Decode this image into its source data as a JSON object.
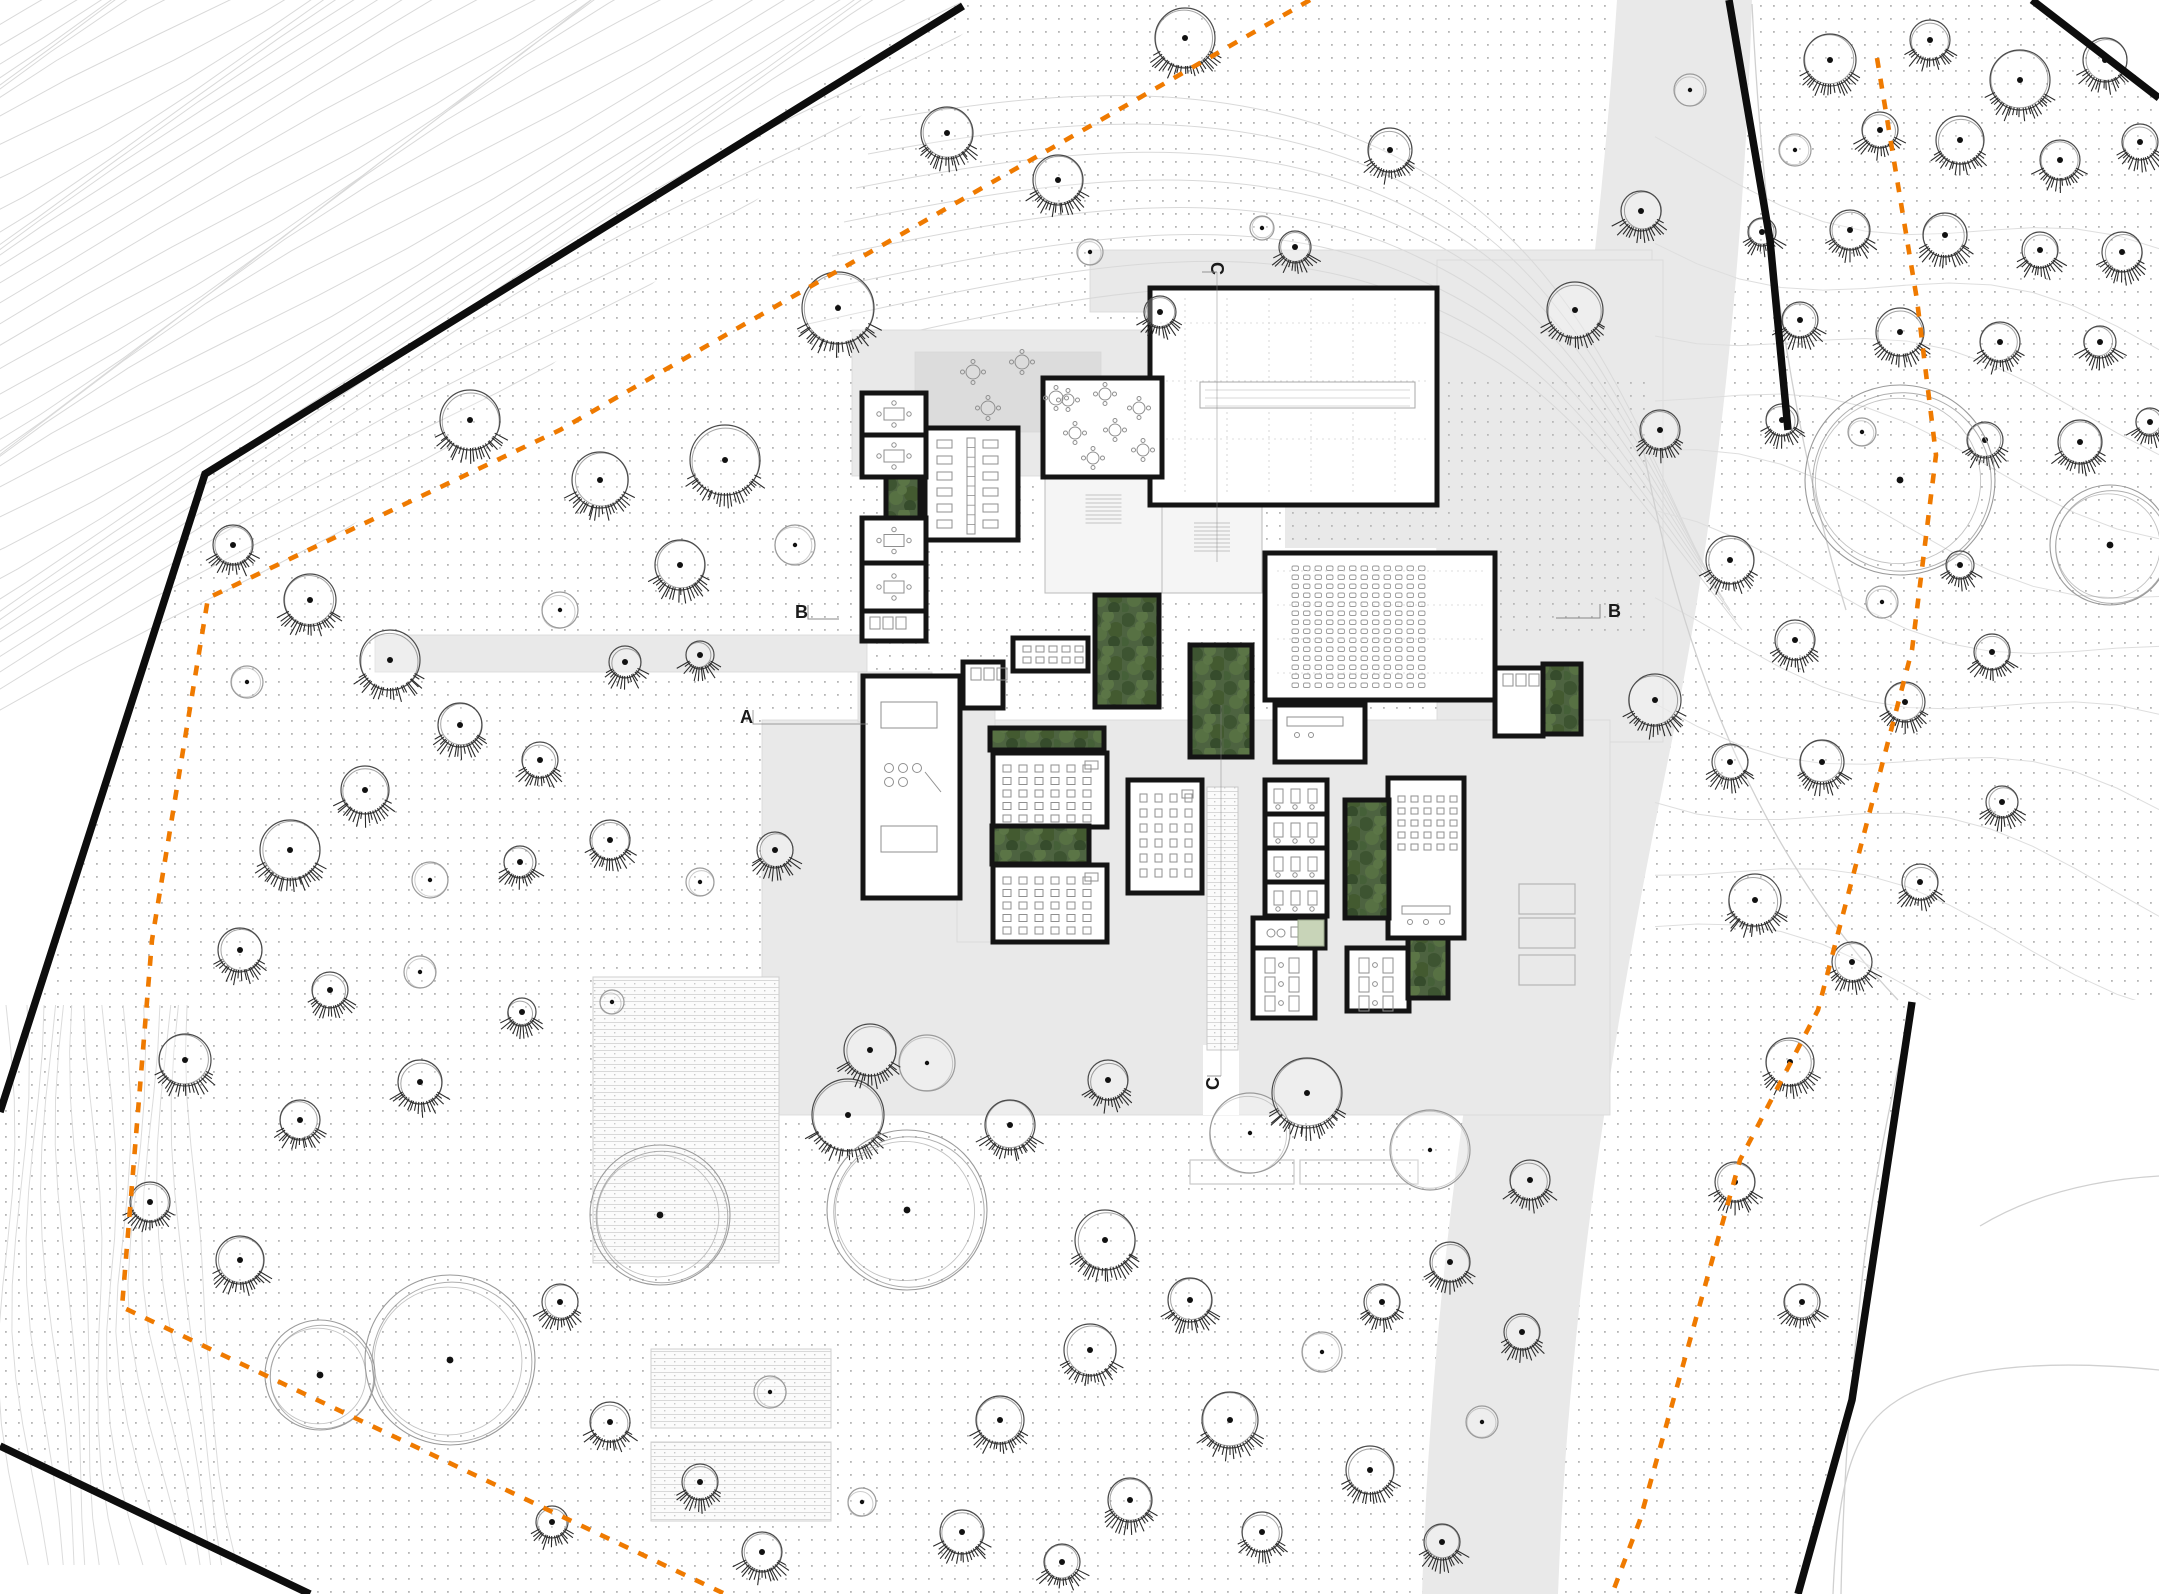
{
  "drawing": {
    "kind": "architectural-site-plan",
    "width": 2159,
    "height": 1594
  },
  "colors": {
    "background": "#ffffff",
    "paving": "#e9e9e9",
    "terrace": "#dcdcdc",
    "wall": "#141414",
    "boundary": "#0d0d0d",
    "orange": "#ef7a00",
    "dot": "#a9a9a9",
    "contour": "#d9d9d9",
    "contour_light": "#e0e0e0",
    "tree_line": "#4a4a4a",
    "tree_light": "#9a9a9a",
    "furniture": "#8f8f8f",
    "room_fill": "#ffffff",
    "foyer_fill": "#f5f5f5",
    "planter_pale": "#c8d4b8",
    "green_shades": [
      "#4d6340",
      "#3b5230",
      "#5c7747",
      "#41592f",
      "#587244",
      "#33492a",
      "#446038"
    ]
  },
  "markers": [
    {
      "label": "B",
      "x": 795,
      "y": 618,
      "rot": 0,
      "tick": "right"
    },
    {
      "label": "A",
      "x": 740,
      "y": 723,
      "rot": 0,
      "tick": "right-long"
    },
    {
      "label": "B",
      "x": 1608,
      "y": 617,
      "rot": 0,
      "tick": "left"
    },
    {
      "label": "C",
      "x": 1211,
      "y": 262,
      "rot": 90,
      "tick": "down"
    },
    {
      "label": "C",
      "x": 1219,
      "y": 1090,
      "rot": -90,
      "tick": "up"
    }
  ],
  "site": {
    "boundary_segments": [
      [
        [
          963,
          6
        ],
        [
          205,
          474
        ],
        [
          0,
          1112
        ]
      ],
      [
        [
          0,
          1446
        ],
        [
          310,
          1594
        ]
      ],
      [
        [
          1729,
          0
        ],
        [
          1770,
          240
        ],
        [
          1788,
          430
        ]
      ],
      [
        [
          1912,
          1002
        ],
        [
          1852,
          1400
        ],
        [
          1798,
          1594
        ]
      ],
      [
        [
          2032,
          0
        ],
        [
          2159,
          98
        ]
      ]
    ],
    "outside_white": [
      [
        [
          0,
          0
        ],
        [
          958,
          0
        ],
        [
          203,
          470
        ],
        [
          0,
          1108
        ]
      ],
      [
        [
          0,
          1450
        ],
        [
          0,
          1594
        ],
        [
          305,
          1594
        ]
      ],
      [
        [
          1916,
          1000
        ],
        [
          2159,
          1000
        ],
        [
          2159,
          1594
        ],
        [
          1800,
          1594
        ],
        [
          1854,
          1400
        ]
      ],
      [
        [
          2036,
          0
        ],
        [
          2159,
          0
        ],
        [
          2159,
          96
        ]
      ]
    ],
    "orange_paths": [
      [
        [
          1310,
          0
        ],
        [
          560,
          430
        ],
        [
          208,
          598
        ],
        [
          152,
          940
        ],
        [
          122,
          1307
        ],
        [
          500,
          1487
        ],
        [
          725,
          1594
        ]
      ],
      [
        [
          1877,
          58
        ],
        [
          1917,
          300
        ],
        [
          1936,
          455
        ],
        [
          1912,
          650
        ],
        [
          1818,
          1010
        ],
        [
          1740,
          1160
        ],
        [
          1640,
          1520
        ],
        [
          1612,
          1594
        ]
      ]
    ]
  },
  "surfaces": [
    {
      "id": "road-east",
      "kind": "road",
      "path": "M1617,0C1600,260,1560,560,1505,860C1460,1100,1430,1340,1422,1594L1558,1594C1568,1320,1610,1040,1668,760C1716,530,1744,260,1752,0Z"
    },
    {
      "id": "band-north",
      "kind": "paving",
      "rect": [
        1090,
        250,
        562,
        62
      ]
    },
    {
      "id": "east-apron",
      "kind": "paving",
      "rect": [
        1437,
        260,
        226,
        482
      ]
    },
    {
      "id": "forecourt-nw",
      "kind": "paving",
      "rect": [
        852,
        330,
        300,
        146
      ]
    },
    {
      "id": "terrace-nw",
      "kind": "terrace",
      "rect": [
        915,
        352,
        186,
        80
      ]
    },
    {
      "id": "walkway-west",
      "kind": "paving",
      "rect": [
        375,
        635,
        492,
        37
      ]
    },
    {
      "id": "plaza-south",
      "kind": "paving",
      "rect": [
        762,
        720,
        848,
        395
      ]
    },
    {
      "id": "corridor-west",
      "kind": "paving",
      "rect": [
        957,
        676,
        38,
        266
      ]
    },
    {
      "id": "wing-link",
      "kind": "paving",
      "rect": [
        858,
        672,
        74,
        50
      ]
    }
  ],
  "dotted_paving": [
    {
      "rect": [
        1437,
        380,
        212,
        262
      ]
    },
    {
      "rect": [
        1285,
        478,
        152,
        70
      ]
    }
  ],
  "paving_cuts": [
    {
      "rect": [
        1203,
        1045,
        36,
        70
      ]
    }
  ],
  "garden_beds": {
    "striped": [
      [
        593,
        977,
        186,
        286
      ],
      [
        651,
        1349,
        180,
        79
      ],
      [
        651,
        1442,
        180,
        79
      ]
    ],
    "outlined": [
      [
        1190,
        1160,
        104,
        24
      ],
      [
        1300,
        1160,
        118,
        24
      ]
    ]
  },
  "parking_pads": [
    [
      1519,
      884,
      56,
      30
    ],
    [
      1519,
      918,
      56,
      30
    ],
    [
      1519,
      955,
      56,
      30
    ]
  ],
  "building": {
    "rooms": [
      {
        "id": "hall",
        "t": "hall",
        "r": [
          1150,
          288,
          287,
          217
        ]
      },
      {
        "id": "cafe",
        "t": "cafe",
        "r": [
          1043,
          378,
          119,
          99
        ]
      },
      {
        "id": "open-office",
        "t": "openoffice",
        "r": [
          925,
          428,
          93,
          112
        ]
      },
      {
        "id": "meeting-1",
        "t": "meeting",
        "r": [
          862,
          393,
          64,
          42
        ]
      },
      {
        "id": "meeting-2",
        "t": "meeting",
        "r": [
          862,
          435,
          64,
          42
        ]
      },
      {
        "id": "meeting-3",
        "t": "meeting",
        "r": [
          862,
          518,
          64,
          45
        ]
      },
      {
        "id": "meeting-4",
        "t": "meeting",
        "r": [
          862,
          563,
          64,
          48
        ]
      },
      {
        "id": "wc-west",
        "t": "wc",
        "r": [
          862,
          611,
          64,
          30
        ]
      },
      {
        "id": "workshop",
        "t": "workshop",
        "r": [
          863,
          676,
          97,
          222
        ]
      },
      {
        "id": "wc-north",
        "t": "wc",
        "r": [
          963,
          662,
          40,
          46
        ]
      },
      {
        "id": "studio",
        "t": "studio",
        "r": [
          1013,
          638,
          75,
          33
        ]
      },
      {
        "id": "classroom-a",
        "t": "classroom",
        "r": [
          993,
          753,
          114,
          74
        ]
      },
      {
        "id": "classroom-b",
        "t": "classroom",
        "r": [
          993,
          865,
          114,
          77
        ]
      },
      {
        "id": "classroom-c",
        "t": "classroomv",
        "r": [
          1128,
          780,
          74,
          113
        ]
      },
      {
        "id": "music-1",
        "t": "music",
        "r": [
          1265,
          780,
          62,
          34
        ]
      },
      {
        "id": "music-2",
        "t": "music",
        "r": [
          1265,
          814,
          62,
          34
        ]
      },
      {
        "id": "music-3",
        "t": "music",
        "r": [
          1265,
          848,
          62,
          34
        ]
      },
      {
        "id": "music-4",
        "t": "music",
        "r": [
          1265,
          882,
          62,
          34
        ]
      },
      {
        "id": "ensemble",
        "t": "ensemble",
        "r": [
          1388,
          778,
          76,
          160
        ]
      },
      {
        "id": "lab",
        "t": "lab",
        "r": [
          1253,
          918,
          72,
          30
        ]
      },
      {
        "id": "office-s1",
        "t": "offices",
        "r": [
          1253,
          948,
          62,
          70
        ]
      },
      {
        "id": "office-s2",
        "t": "offices",
        "r": [
          1347,
          948,
          62,
          63
        ]
      },
      {
        "id": "auditorium",
        "t": "auditorium",
        "r": [
          1265,
          553,
          230,
          147
        ]
      },
      {
        "id": "annex-wc",
        "t": "wc",
        "r": [
          1495,
          668,
          48,
          68
        ]
      },
      {
        "id": "control",
        "t": "control",
        "r": [
          1275,
          705,
          90,
          57
        ]
      }
    ],
    "foyers": [
      {
        "id": "foyer-main",
        "r": [
          1162,
          505,
          100,
          88
        ]
      },
      {
        "id": "foyer-west",
        "r": [
          1045,
          477,
          117,
          116
        ]
      }
    ],
    "courtyards": [
      {
        "id": "court-1",
        "r": [
          1095,
          595,
          64,
          112
        ]
      },
      {
        "id": "court-2",
        "r": [
          1190,
          645,
          62,
          112
        ]
      },
      {
        "id": "court-strip-a",
        "r": [
          990,
          728,
          114,
          22
        ]
      },
      {
        "id": "court-strip-b",
        "r": [
          992,
          826,
          97,
          38
        ]
      },
      {
        "id": "court-music",
        "r": [
          1345,
          800,
          44,
          118
        ]
      },
      {
        "id": "court-south",
        "r": [
          1408,
          938,
          40,
          60
        ]
      },
      {
        "id": "court-east",
        "r": [
          1543,
          664,
          38,
          70
        ]
      },
      {
        "id": "court-west",
        "r": [
          886,
          477,
          34,
          41
        ]
      }
    ],
    "pale_planters": [
      [
        1298,
        920,
        26,
        26
      ]
    ],
    "planting_strip": [
      1207,
      787,
      31,
      263
    ],
    "terrace_tables": [
      [
        973,
        372
      ],
      [
        1022,
        362
      ],
      [
        1056,
        398
      ],
      [
        988,
        408
      ]
    ]
  },
  "trees": [
    [
      947,
      133,
      26,
      1
    ],
    [
      1058,
      180,
      25,
      1
    ],
    [
      1185,
      38,
      30,
      1
    ],
    [
      838,
      308,
      36,
      1
    ],
    [
      1390,
      150,
      22,
      1
    ],
    [
      1262,
      228,
      12,
      0
    ],
    [
      1295,
      247,
      16,
      1
    ],
    [
      1160,
      312,
      16,
      1
    ],
    [
      1090,
      252,
      13,
      0
    ],
    [
      1575,
      310,
      28,
      1
    ],
    [
      1641,
      211,
      20,
      1
    ],
    [
      1690,
      90,
      16,
      0
    ],
    [
      1830,
      60,
      26,
      1
    ],
    [
      1930,
      40,
      20,
      1
    ],
    [
      2020,
      80,
      30,
      1
    ],
    [
      2105,
      60,
      22,
      1
    ],
    [
      1795,
      150,
      16,
      0
    ],
    [
      1880,
      130,
      18,
      1
    ],
    [
      1960,
      140,
      24,
      1
    ],
    [
      2060,
      160,
      20,
      1
    ],
    [
      2140,
      142,
      18,
      1
    ],
    [
      1762,
      232,
      14,
      1
    ],
    [
      1850,
      230,
      20,
      1
    ],
    [
      1945,
      235,
      22,
      1
    ],
    [
      2040,
      250,
      18,
      1
    ],
    [
      2122,
      252,
      20,
      1
    ],
    [
      1800,
      320,
      18,
      1
    ],
    [
      1900,
      332,
      24,
      1
    ],
    [
      2000,
      342,
      20,
      1
    ],
    [
      2100,
      342,
      16,
      1
    ],
    [
      1782,
      420,
      16,
      1
    ],
    [
      1862,
      432,
      14,
      0
    ],
    [
      1985,
      440,
      18,
      1
    ],
    [
      2080,
      442,
      22,
      1
    ],
    [
      2150,
      422,
      14,
      1
    ],
    [
      1660,
      430,
      20,
      1
    ],
    [
      1900,
      480,
      95,
      2
    ],
    [
      2110,
      545,
      60,
      2
    ],
    [
      1730,
      560,
      24,
      1
    ],
    [
      1960,
      565,
      14,
      1
    ],
    [
      1795,
      640,
      20,
      1
    ],
    [
      1655,
      700,
      26,
      1
    ],
    [
      1882,
      602,
      16,
      0
    ],
    [
      1730,
      762,
      18,
      1
    ],
    [
      1822,
      762,
      22,
      1
    ],
    [
      1905,
      702,
      20,
      1
    ],
    [
      1992,
      652,
      18,
      1
    ],
    [
      1755,
      900,
      26,
      1
    ],
    [
      1852,
      962,
      20,
      1
    ],
    [
      1920,
      882,
      18,
      1
    ],
    [
      2002,
      802,
      16,
      1
    ],
    [
      1790,
      1062,
      24,
      1
    ],
    [
      1735,
      1182,
      20,
      1
    ],
    [
      1802,
      1302,
      18,
      1
    ],
    [
      233,
      545,
      20,
      1
    ],
    [
      310,
      600,
      26,
      1
    ],
    [
      390,
      660,
      30,
      1
    ],
    [
      247,
      682,
      16,
      0
    ],
    [
      470,
      420,
      30,
      1
    ],
    [
      600,
      480,
      28,
      1
    ],
    [
      725,
      460,
      35,
      1
    ],
    [
      795,
      545,
      20,
      0
    ],
    [
      680,
      565,
      25,
      1
    ],
    [
      560,
      610,
      18,
      0
    ],
    [
      625,
      662,
      16,
      1
    ],
    [
      700,
      655,
      14,
      1
    ],
    [
      460,
      725,
      22,
      1
    ],
    [
      540,
      760,
      18,
      1
    ],
    [
      365,
      790,
      24,
      1
    ],
    [
      290,
      850,
      30,
      1
    ],
    [
      430,
      880,
      18,
      0
    ],
    [
      520,
      862,
      16,
      1
    ],
    [
      610,
      840,
      20,
      1
    ],
    [
      700,
      882,
      14,
      0
    ],
    [
      775,
      850,
      18,
      1
    ],
    [
      240,
      950,
      22,
      1
    ],
    [
      330,
      990,
      18,
      1
    ],
    [
      420,
      972,
      16,
      0
    ],
    [
      185,
      1060,
      26,
      1
    ],
    [
      300,
      1120,
      20,
      1
    ],
    [
      420,
      1082,
      22,
      1
    ],
    [
      522,
      1012,
      14,
      1
    ],
    [
      612,
      1002,
      12,
      0
    ],
    [
      240,
      1260,
      24,
      1
    ],
    [
      150,
      1202,
      20,
      1
    ],
    [
      320,
      1375,
      55,
      2
    ],
    [
      450,
      1360,
      85,
      2
    ],
    [
      560,
      1302,
      18,
      1
    ],
    [
      610,
      1422,
      20,
      1
    ],
    [
      660,
      1215,
      70,
      2
    ],
    [
      770,
      1392,
      16,
      0
    ],
    [
      700,
      1482,
      18,
      1
    ],
    [
      552,
      1522,
      16,
      1
    ],
    [
      762,
      1552,
      20,
      1
    ],
    [
      862,
      1502,
      14,
      0
    ],
    [
      962,
      1532,
      22,
      1
    ],
    [
      1062,
      1562,
      18,
      1
    ],
    [
      848,
      1115,
      36,
      1
    ],
    [
      927,
      1063,
      28,
      0
    ],
    [
      907,
      1210,
      80,
      2
    ],
    [
      1010,
      1125,
      25,
      1
    ],
    [
      1108,
      1080,
      20,
      1
    ],
    [
      1250,
      1133,
      40,
      0
    ],
    [
      1307,
      1093,
      35,
      1
    ],
    [
      1430,
      1150,
      40,
      0
    ],
    [
      1105,
      1240,
      30,
      1
    ],
    [
      1190,
      1300,
      22,
      1
    ],
    [
      1090,
      1350,
      26,
      1
    ],
    [
      1000,
      1420,
      24,
      1
    ],
    [
      1230,
      1420,
      28,
      1
    ],
    [
      1322,
      1352,
      20,
      0
    ],
    [
      1382,
      1302,
      18,
      1
    ],
    [
      1130,
      1500,
      22,
      1
    ],
    [
      1262,
      1532,
      20,
      1
    ],
    [
      1370,
      1470,
      24,
      1
    ],
    [
      1442,
      1542,
      18,
      1
    ],
    [
      1482,
      1422,
      16,
      0
    ],
    [
      1450,
      1262,
      20,
      1
    ],
    [
      1522,
      1332,
      18,
      1
    ],
    [
      1530,
      1180,
      20,
      1
    ],
    [
      870,
      1050,
      26,
      1
    ]
  ]
}
